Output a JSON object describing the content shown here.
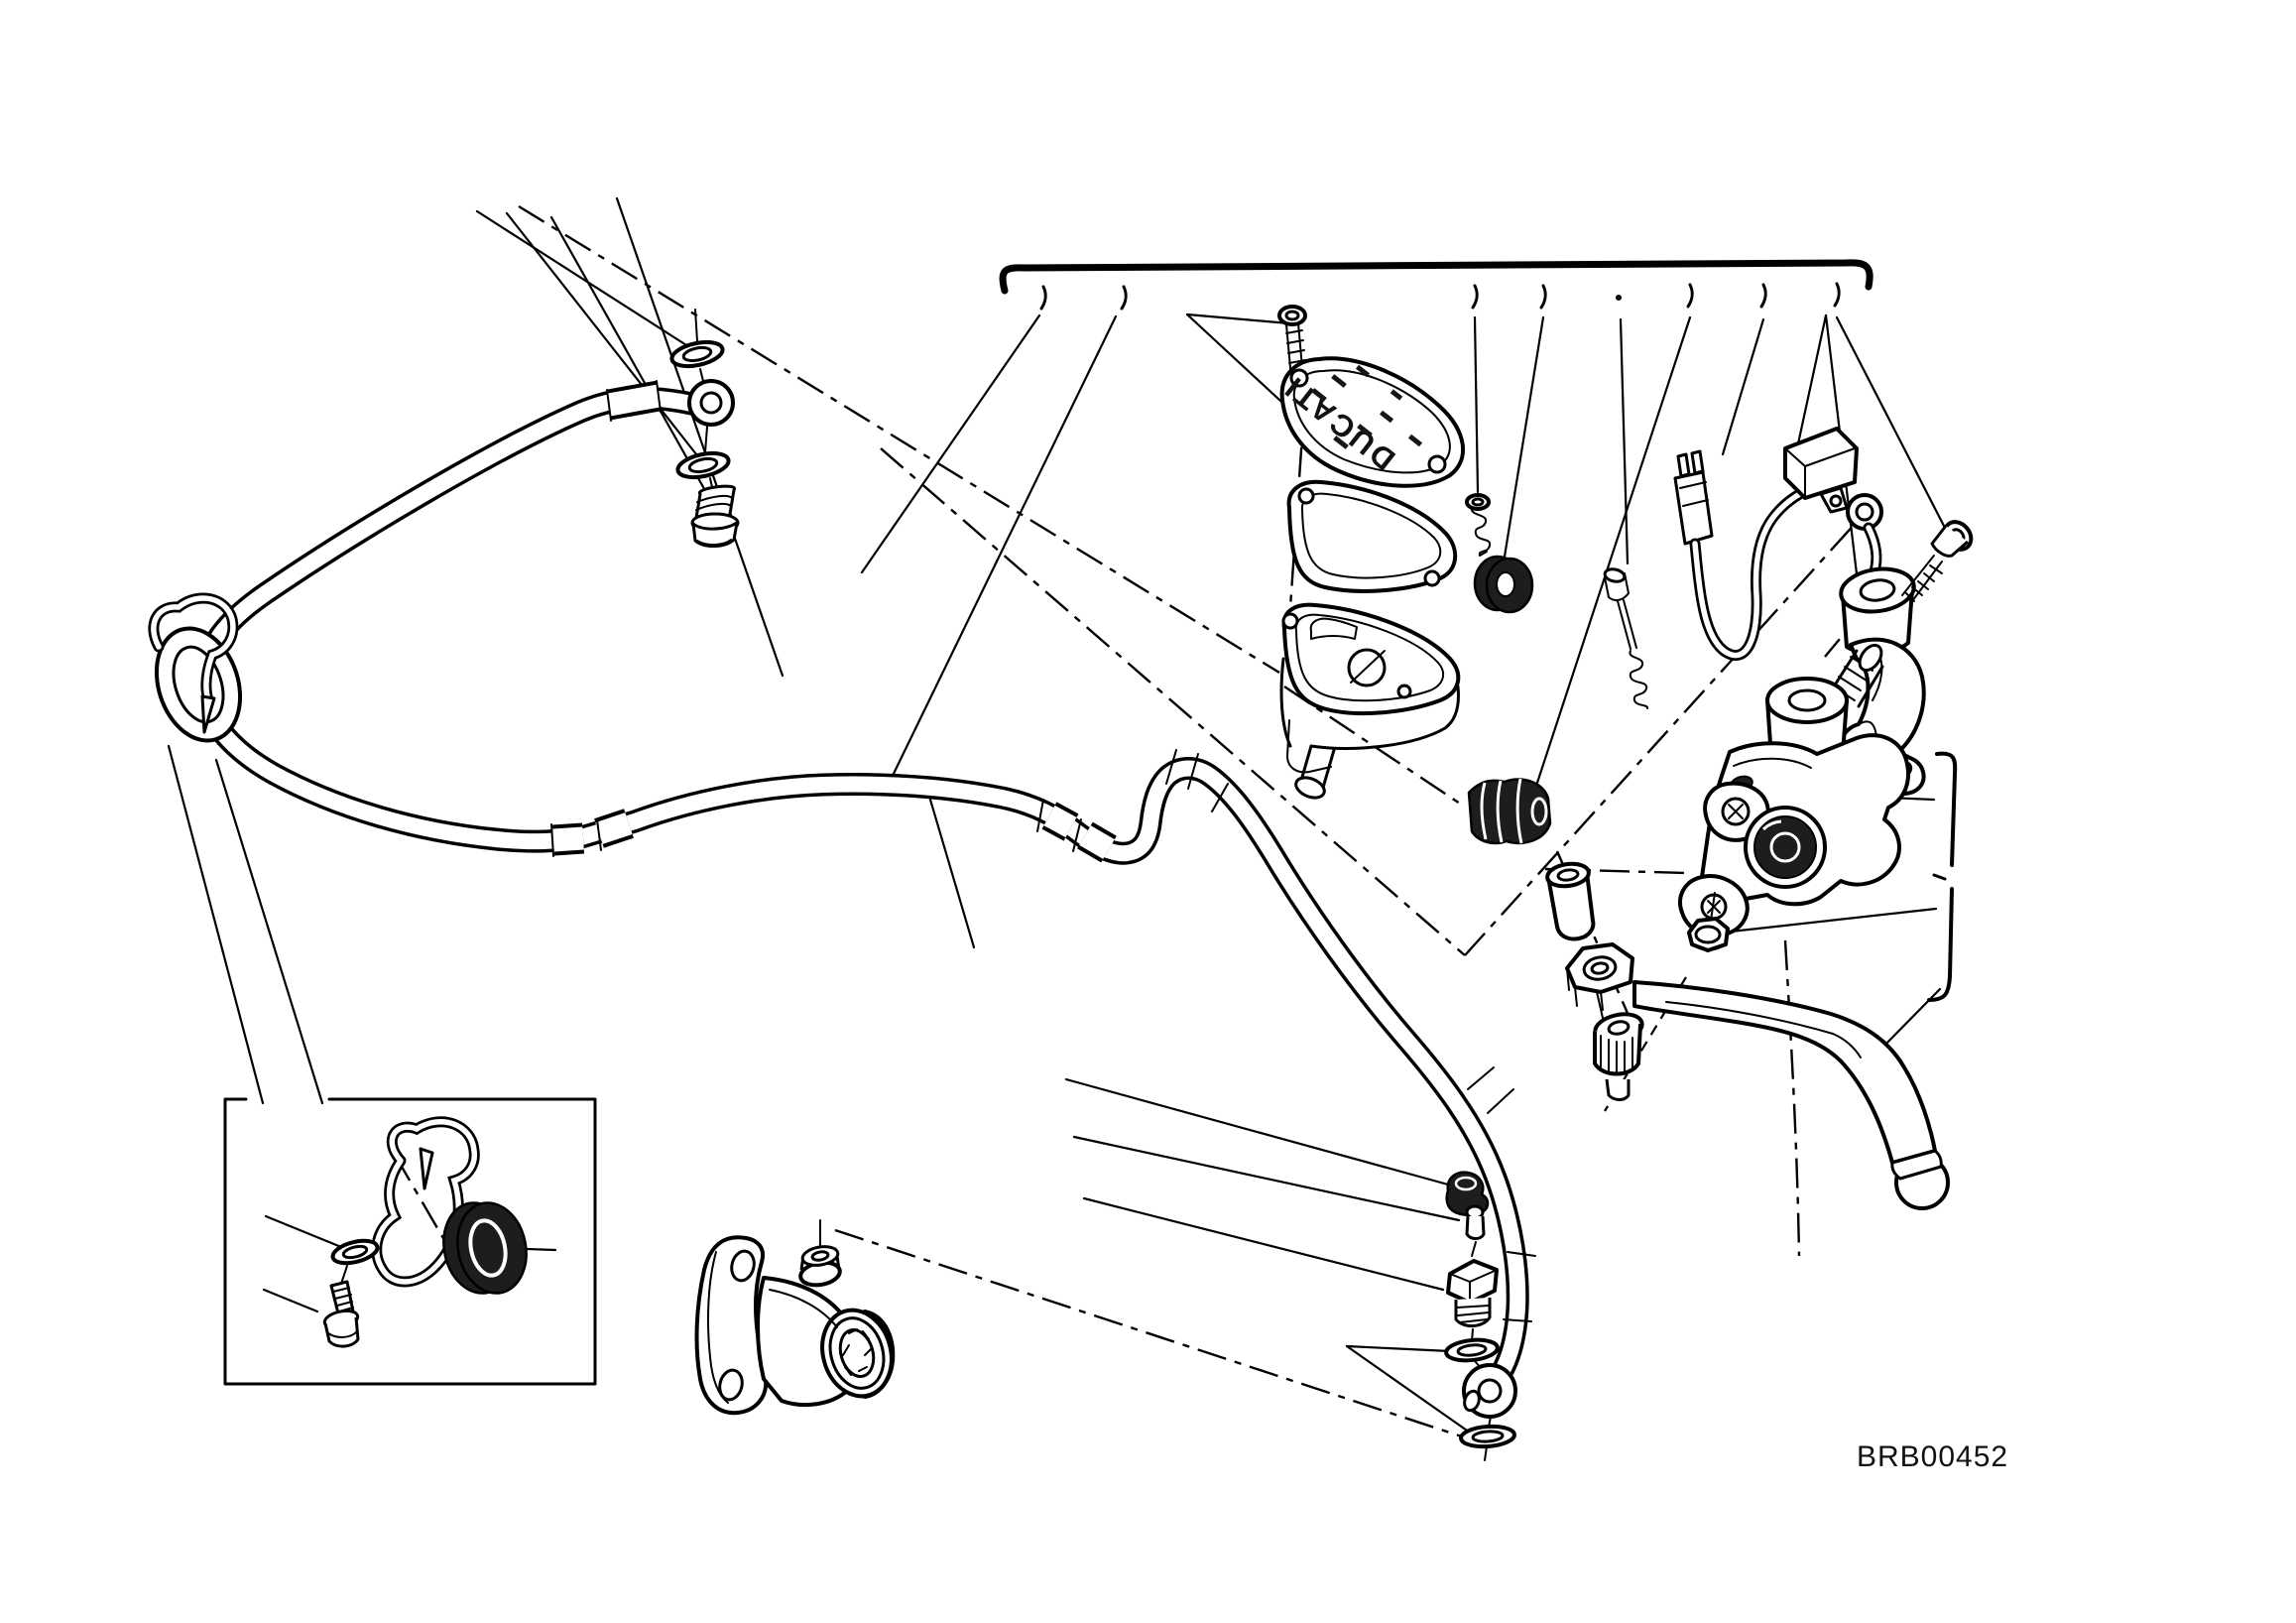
{
  "figure": {
    "code": "BRB00452",
    "cap_brand": "DUCATI"
  },
  "colors": {
    "background": "#ffffff",
    "line": "#000000",
    "rubber_dark": "#1d1d1d"
  },
  "diagram": {
    "type": "exploded-parts-drawing",
    "subject": "clutch master cylinder and hose assembly",
    "parts": [
      "clutch-hose",
      "hose-guide-grommet",
      "hose-guide-clip",
      "upper-banjo-eyelet",
      "upper-sealing-washer",
      "lower-sealing-washer",
      "banjo-bolt",
      "inset-detail-box",
      "inset-screw",
      "inset-spring-washer",
      "inset-wire-clip",
      "inset-grommet",
      "clutch-slave-cylinder",
      "reservoir-cap-screw",
      "reservoir-cap",
      "cap-gasket",
      "fluid-reservoir",
      "reservoir-screw-spring",
      "reservoir-grommet",
      "diaphragm-bellows",
      "spacer-bushing",
      "pushrod-spring",
      "switch-connector",
      "clutch-switch-wire",
      "master-cylinder-body",
      "piston-bore",
      "handlebar-clamp",
      "clamp-bolt",
      "flange-nut",
      "lever-adjuster",
      "clutch-lever",
      "hose-end-fitting",
      "bleed-valve-cap",
      "bleed-nipple",
      "bleed-valve",
      "lower-banjo-eyelet",
      "top-callout-bracket",
      "right-callout-bracket"
    ]
  }
}
